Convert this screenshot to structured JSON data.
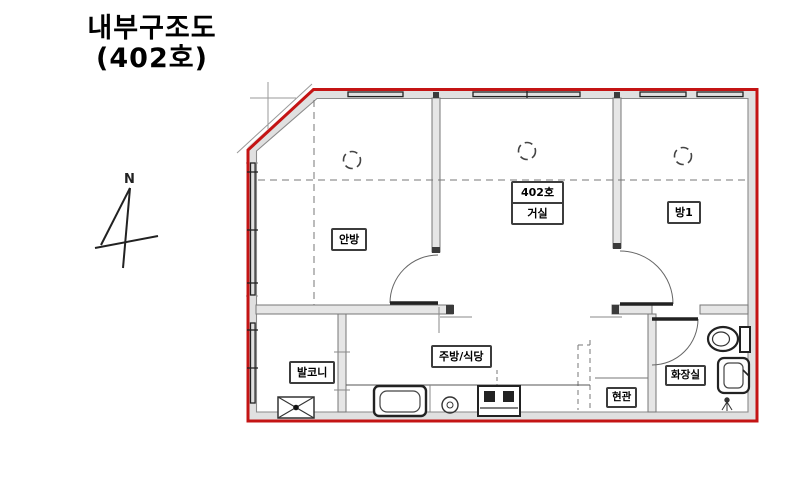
{
  "title": {
    "line1": "내부구조도",
    "line2": "(402호)"
  },
  "compass": {
    "north_label": "N"
  },
  "rooms": {
    "master_bedroom": "안방",
    "unit_number": "402호",
    "living_room": "거실",
    "bedroom1": "방1",
    "balcony": "발코니",
    "kitchen_dining": "주방/식당",
    "bathroom": "화장실",
    "entrance": "현관"
  },
  "colors": {
    "unit_outline": "#c41414",
    "wall_fill": "#e3e3e3",
    "line": "#333333"
  }
}
